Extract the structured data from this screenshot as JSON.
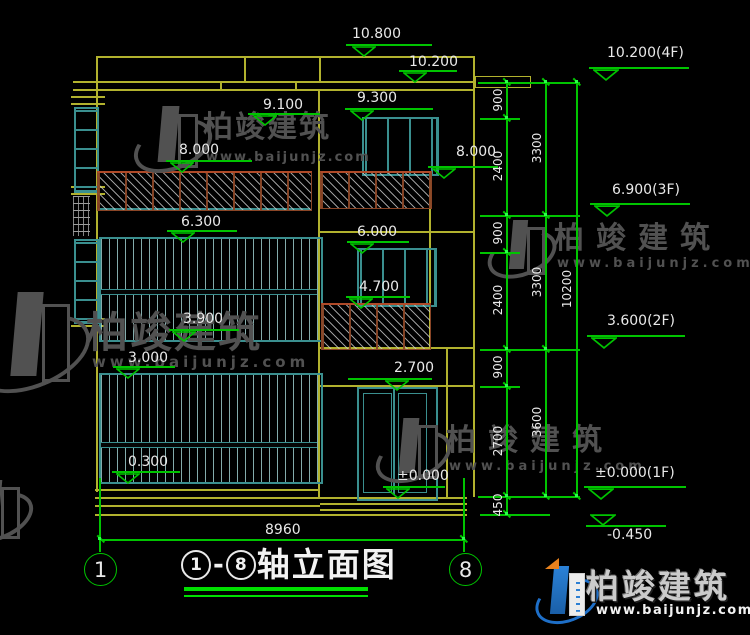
{
  "levels": {
    "v10800": "10.800",
    "v10200": "10.200",
    "v9100": "9.100",
    "v9300": "9.300",
    "v8000l": "8.000",
    "v8000r": "8.000",
    "v6300": "6.300",
    "v6000": "6.000",
    "v4700": "4.700",
    "v3900": "3.900",
    "v3000": "3.000",
    "v2700": "2.700",
    "v0300": "0.300",
    "v0000": "±0.000"
  },
  "floor_levels": {
    "f4": "10.200(4F)",
    "f3": "6.900(3F)",
    "f2": "3.600(2F)",
    "f1": "±0.000(1F)",
    "base": "-0.450"
  },
  "dims": {
    "chain1": [
      "900",
      "2400",
      "900",
      "2400",
      "900",
      "2700",
      "450"
    ],
    "chain2": [
      "3300",
      "3300",
      "3600"
    ],
    "chain3": [
      "10200"
    ],
    "overall_width": "8960"
  },
  "axes": {
    "left": "1",
    "right": "8"
  },
  "title": {
    "axis_left": "1",
    "dash": "-",
    "axis_right": "8",
    "name": "轴立面图"
  },
  "brand": {
    "name": "柏竣建筑",
    "site": "www.baijunjz.com"
  },
  "colors": {
    "line_yellow": "#b2b22e",
    "line_teal": "#3a8f8f",
    "line_green": "#00c400",
    "rail_brown": "#8a4526",
    "text_white": "#e9e9e9",
    "logo_blue": "#1e6fc8",
    "logo_orange": "#e8821e"
  }
}
